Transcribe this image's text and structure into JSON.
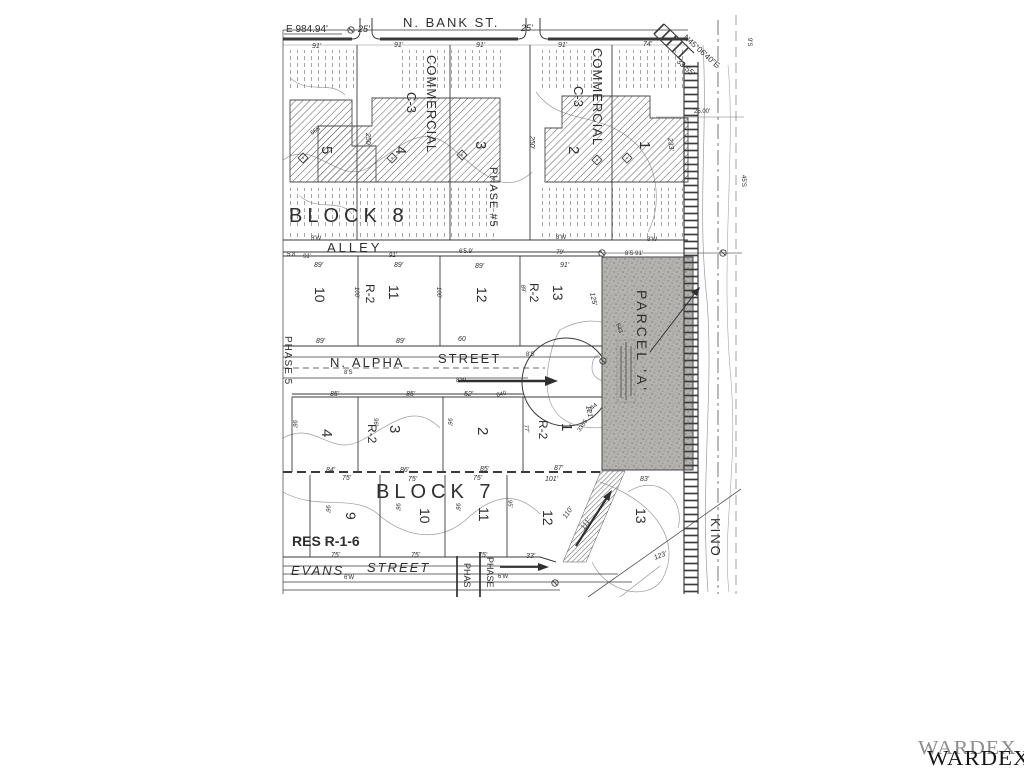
{
  "watermark": {
    "back_text": "WARDEX",
    "front_text": "WARDEX",
    "back_color": "#8d8d8d",
    "front_color": "#151515"
  },
  "map": {
    "ink": "#2f2f2f",
    "light_ink": "#7d7d7d",
    "parcel_fill": "#b4b2af",
    "labels": [
      {
        "n": "e-coordinate",
        "t": "E 984.94'",
        "x": 286,
        "y": 32,
        "s": 10
      },
      {
        "n": "dim-25-a",
        "t": "25'",
        "x": 358,
        "y": 32,
        "s": 9,
        "i": 1
      },
      {
        "n": "n-bank-st",
        "t": "N. BANK ST.",
        "x": 403,
        "y": 27,
        "s": 13,
        "ls": 2
      },
      {
        "n": "dim-25-b",
        "t": "25'",
        "x": 521,
        "y": 31,
        "s": 9,
        "i": 1
      },
      {
        "n": "bearing-ne",
        "t": "N45°06'40\"E",
        "x": 683,
        "y": 38,
        "s": 8,
        "r": 42
      },
      {
        "n": "bearing-dist",
        "t": "33.55'",
        "x": 676,
        "y": 62,
        "s": 8,
        "r": 42
      },
      {
        "n": "dim-91-a",
        "t": "91'",
        "x": 312,
        "y": 48,
        "s": 7,
        "i": 1
      },
      {
        "n": "dim-91-b",
        "t": "91'",
        "x": 394,
        "y": 47,
        "s": 7,
        "i": 1
      },
      {
        "n": "dim-91-c",
        "t": "91'",
        "x": 476,
        "y": 47,
        "s": 7,
        "i": 1
      },
      {
        "n": "dim-91-d",
        "t": "91'",
        "x": 558,
        "y": 47,
        "s": 7,
        "i": 1
      },
      {
        "n": "dim-74",
        "t": "74'",
        "x": 643,
        "y": 46,
        "s": 7,
        "i": 1
      },
      {
        "n": "commercial-a",
        "t": "COMMERCIAL",
        "x": 427,
        "y": 55,
        "s": 13,
        "r": 90,
        "ls": 1
      },
      {
        "n": "c3-a",
        "t": "C-3",
        "x": 407,
        "y": 92,
        "s": 13,
        "r": 90
      },
      {
        "n": "commercial-b",
        "t": "COMMERCIAL",
        "x": 593,
        "y": 48,
        "s": 13,
        "r": 90,
        "ls": 1
      },
      {
        "n": "c3-b",
        "t": "C-3",
        "x": 574,
        "y": 86,
        "s": 13,
        "r": 90
      },
      {
        "n": "lot8-5",
        "t": "5",
        "x": 322,
        "y": 146,
        "s": 15,
        "r": 90
      },
      {
        "n": "lot8-4",
        "t": "4",
        "x": 396,
        "y": 146,
        "s": 15,
        "r": 90
      },
      {
        "n": "lot8-3",
        "t": "3",
        "x": 476,
        "y": 141,
        "s": 15,
        "r": 90
      },
      {
        "n": "lot8-2",
        "t": "2",
        "x": 569,
        "y": 146,
        "s": 15,
        "r": 90
      },
      {
        "n": "lot8-1",
        "t": "1",
        "x": 640,
        "y": 141,
        "s": 15,
        "r": 90
      },
      {
        "n": "dim-250-a",
        "t": "250'",
        "x": 366,
        "y": 133,
        "s": 7,
        "r": 90,
        "i": 1
      },
      {
        "n": "dim-250-b",
        "t": "250'",
        "x": 530,
        "y": 136,
        "s": 7,
        "r": 90,
        "i": 1
      },
      {
        "n": "dim-233",
        "t": "233'",
        "x": 668,
        "y": 138,
        "s": 7,
        "r": 84,
        "i": 1
      },
      {
        "n": "contour-665",
        "t": "665",
        "x": 312,
        "y": 135,
        "s": 6,
        "r": -35,
        "c": "#7d7d7d"
      },
      {
        "n": "block8-title",
        "t": "BLOCK 8",
        "x": 289,
        "y": 222,
        "s": 20,
        "ls": 5
      },
      {
        "n": "phase-5-hash",
        "t": "PHASE #5",
        "x": 490,
        "y": 167,
        "s": 11,
        "r": 90,
        "ls": 1
      },
      {
        "n": "alley",
        "t": "ALLEY",
        "x": 327,
        "y": 252,
        "s": 13,
        "ls": 3
      },
      {
        "n": "dim-8w-a",
        "t": "8'W",
        "x": 311,
        "y": 240,
        "s": 6
      },
      {
        "n": "dim-8w-b",
        "t": "8'W",
        "x": 556,
        "y": 239,
        "s": 6
      },
      {
        "n": "dim-8w-c",
        "t": "8'W",
        "x": 647,
        "y": 241,
        "s": 6
      },
      {
        "n": "dim-58",
        "t": "5.8",
        "x": 287,
        "y": 256,
        "s": 6
      },
      {
        "n": "dim-91-e",
        "t": "91'",
        "x": 303,
        "y": 258,
        "s": 6,
        "i": 1
      },
      {
        "n": "dim-91-f",
        "t": "91'",
        "x": 389,
        "y": 257,
        "s": 6,
        "i": 1
      },
      {
        "n": "dim-659",
        "t": "6'5.9'",
        "x": 459,
        "y": 253,
        "s": 6
      },
      {
        "n": "dim-79",
        "t": "79'",
        "x": 556,
        "y": 254,
        "s": 6,
        "i": 1
      },
      {
        "n": "dim-8s91",
        "t": "8'S 91'",
        "x": 625,
        "y": 255,
        "s": 6
      },
      {
        "n": "dim-89-a",
        "t": "89'",
        "x": 314,
        "y": 267,
        "s": 7,
        "i": 1
      },
      {
        "n": "dim-89-b",
        "t": "89'",
        "x": 394,
        "y": 267,
        "s": 7,
        "i": 1
      },
      {
        "n": "dim-89-c",
        "t": "89'",
        "x": 475,
        "y": 268,
        "s": 7,
        "i": 1
      },
      {
        "n": "dim-91-g",
        "t": "91'",
        "x": 560,
        "y": 267,
        "s": 7,
        "i": 1
      },
      {
        "n": "lot-10",
        "t": "10",
        "x": 315,
        "y": 287,
        "s": 14,
        "r": 90
      },
      {
        "n": "lot-11",
        "t": "11",
        "x": 389,
        "y": 285,
        "s": 14,
        "r": 90
      },
      {
        "n": "r2-a",
        "t": "R-2",
        "x": 366,
        "y": 284,
        "s": 12,
        "r": 90
      },
      {
        "n": "lot-12",
        "t": "12",
        "x": 477,
        "y": 287,
        "s": 14,
        "r": 90
      },
      {
        "n": "lot-13",
        "t": "13",
        "x": 553,
        "y": 285,
        "s": 14,
        "r": 90
      },
      {
        "n": "r2-b",
        "t": "R-2",
        "x": 530,
        "y": 283,
        "s": 12,
        "r": 90
      },
      {
        "n": "dim-100-a",
        "t": "100'",
        "x": 355,
        "y": 287,
        "s": 6,
        "r": 90,
        "i": 1
      },
      {
        "n": "dim-100-b",
        "t": "100'",
        "x": 437,
        "y": 287,
        "s": 6,
        "r": 90,
        "i": 1
      },
      {
        "n": "dim-89-d",
        "t": "89'",
        "x": 521,
        "y": 285,
        "s": 6,
        "r": 80,
        "i": 1
      },
      {
        "n": "dim-125",
        "t": "125'",
        "x": 590,
        "y": 293,
        "s": 7,
        "r": 78,
        "i": 1
      },
      {
        "n": "phase-5-left",
        "t": "PHASE 5",
        "x": 285,
        "y": 336,
        "s": 10,
        "r": 90,
        "ls": 1
      },
      {
        "n": "dim-89-e",
        "t": "89'",
        "x": 316,
        "y": 343,
        "s": 7,
        "i": 1
      },
      {
        "n": "dim-89-f",
        "t": "89'",
        "x": 396,
        "y": 343,
        "s": 7,
        "i": 1
      },
      {
        "n": "n-alpha",
        "t": "N. ALPHA",
        "x": 330,
        "y": 367,
        "s": 13,
        "ls": 2
      },
      {
        "n": "n-alpha-street",
        "t": "STREET",
        "x": 438,
        "y": 363,
        "s": 13,
        "ls": 2
      },
      {
        "n": "dim-8s-a",
        "t": "8'S",
        "x": 344,
        "y": 374,
        "s": 6
      },
      {
        "n": "dim-8w-d",
        "t": "8'W",
        "x": 456,
        "y": 382,
        "s": 6
      },
      {
        "n": "dim-8s-b",
        "t": "8'S",
        "x": 526,
        "y": 356,
        "s": 6
      },
      {
        "n": "dim-60",
        "t": "60",
        "x": 458,
        "y": 341,
        "s": 7,
        "i": 1
      },
      {
        "n": "dim-85-a",
        "t": "85'",
        "x": 330,
        "y": 396,
        "s": 7,
        "i": 1
      },
      {
        "n": "dim-85-b",
        "t": "85'",
        "x": 406,
        "y": 396,
        "s": 7,
        "i": 1
      },
      {
        "n": "dim-52",
        "t": "52'",
        "x": 464,
        "y": 396,
        "s": 7,
        "i": 1
      },
      {
        "n": "lot7-4",
        "t": "4",
        "x": 322,
        "y": 429,
        "s": 15,
        "r": 90
      },
      {
        "n": "lot7-3",
        "t": "3",
        "x": 390,
        "y": 425,
        "s": 15,
        "r": 90
      },
      {
        "n": "r2-c",
        "t": "R-2",
        "x": 368,
        "y": 424,
        "s": 12,
        "r": 90
      },
      {
        "n": "lot7-2",
        "t": "2",
        "x": 478,
        "y": 427,
        "s": 15,
        "r": 90
      },
      {
        "n": "lot7-1",
        "t": "1",
        "x": 562,
        "y": 423,
        "s": 15,
        "r": 90
      },
      {
        "n": "r2-d",
        "t": "R-2",
        "x": 539,
        "y": 420,
        "s": 12,
        "r": 90
      },
      {
        "n": "dim-96-a",
        "t": "96'",
        "x": 293,
        "y": 420,
        "s": 6,
        "r": 90,
        "i": 1
      },
      {
        "n": "dim-96-b",
        "t": "96'",
        "x": 374,
        "y": 418,
        "s": 6,
        "r": 90,
        "i": 1
      },
      {
        "n": "dim-96-c",
        "t": "96'",
        "x": 448,
        "y": 418,
        "s": 6,
        "r": 90,
        "i": 1
      },
      {
        "n": "dim-77",
        "t": "77'",
        "x": 524,
        "y": 425,
        "s": 6,
        "r": 80,
        "i": 1
      },
      {
        "n": "dim-121",
        "t": "121'",
        "x": 586,
        "y": 406,
        "s": 7,
        "r": 78,
        "i": 1
      },
      {
        "n": "contour-3355",
        "t": "3355",
        "x": 580,
        "y": 432,
        "s": 6,
        "r": -55,
        "c": "#7d7d7d"
      },
      {
        "n": "dim-84",
        "t": "84'",
        "x": 326,
        "y": 472,
        "s": 7,
        "i": 1
      },
      {
        "n": "dim-86",
        "t": "86'",
        "x": 400,
        "y": 472,
        "s": 7,
        "i": 1
      },
      {
        "n": "dim-85-c",
        "t": "85'",
        "x": 480,
        "y": 471,
        "s": 7,
        "i": 1
      },
      {
        "n": "dim-87",
        "t": "87'",
        "x": 554,
        "y": 470,
        "s": 7,
        "i": 1
      },
      {
        "n": "dim-101",
        "t": "101'",
        "x": 545,
        "y": 481,
        "s": 7,
        "i": 1
      },
      {
        "n": "dim-83",
        "t": "83'",
        "x": 640,
        "y": 481,
        "s": 7,
        "i": 1
      },
      {
        "n": "dim-75-a",
        "t": "75'",
        "x": 342,
        "y": 480,
        "s": 7,
        "i": 1
      },
      {
        "n": "dim-75-b",
        "t": "75'",
        "x": 408,
        "y": 481,
        "s": 7,
        "i": 1
      },
      {
        "n": "dim-75-c",
        "t": "75'",
        "x": 473,
        "y": 480,
        "s": 7,
        "i": 1
      },
      {
        "n": "block7-title",
        "t": "BLOCK 7",
        "x": 376,
        "y": 498,
        "s": 20,
        "ls": 5
      },
      {
        "n": "lot7-9",
        "t": "9",
        "x": 346,
        "y": 512,
        "s": 14,
        "r": 90
      },
      {
        "n": "lot7-10",
        "t": "10",
        "x": 420,
        "y": 508,
        "s": 14,
        "r": 90
      },
      {
        "n": "lot7-11",
        "t": "11",
        "x": 479,
        "y": 507,
        "s": 14,
        "r": 90
      },
      {
        "n": "lot7-12",
        "t": "12",
        "x": 543,
        "y": 510,
        "s": 14,
        "r": 90
      },
      {
        "n": "lot7-13",
        "t": "13",
        "x": 636,
        "y": 508,
        "s": 14,
        "r": 90
      },
      {
        "n": "dim-96-d",
        "t": "96'",
        "x": 326,
        "y": 505,
        "s": 6,
        "r": 90,
        "i": 1
      },
      {
        "n": "dim-96-e",
        "t": "96'",
        "x": 396,
        "y": 503,
        "s": 6,
        "r": 90,
        "i": 1
      },
      {
        "n": "dim-96-f",
        "t": "96'",
        "x": 456,
        "y": 503,
        "s": 6,
        "r": 90,
        "i": 1
      },
      {
        "n": "dim-95",
        "t": "95'",
        "x": 508,
        "y": 500,
        "s": 6,
        "r": 84,
        "i": 1
      },
      {
        "n": "res-r-1-6",
        "t": "RES R-1-6",
        "x": 292,
        "y": 546,
        "s": 14,
        "b": 1
      },
      {
        "n": "dim-75-d",
        "t": "75'",
        "x": 331,
        "y": 557,
        "s": 7,
        "i": 1
      },
      {
        "n": "dim-75-e",
        "t": "75'",
        "x": 411,
        "y": 557,
        "s": 7,
        "i": 1
      },
      {
        "n": "dim-75-f",
        "t": "75'",
        "x": 478,
        "y": 557,
        "s": 7,
        "i": 1
      },
      {
        "n": "dim-33",
        "t": "33'",
        "x": 526,
        "y": 558,
        "s": 7,
        "i": 1
      },
      {
        "n": "evans",
        "t": "EVANS",
        "x": 291,
        "y": 575,
        "s": 13,
        "i": 1,
        "ls": 2
      },
      {
        "n": "evans-street",
        "t": "STREET",
        "x": 367,
        "y": 572,
        "s": 13,
        "i": 1,
        "ls": 2
      },
      {
        "n": "phase-evans-a",
        "t": "PHAS",
        "x": 464,
        "y": 563,
        "s": 9,
        "r": 90
      },
      {
        "n": "phase-evans-b",
        "t": "PHASE",
        "x": 487,
        "y": 557,
        "s": 9,
        "r": 90
      },
      {
        "n": "dim-6w-a",
        "t": "6'W",
        "x": 344,
        "y": 579,
        "s": 6
      },
      {
        "n": "dim-6w-b",
        "t": "6'W",
        "x": 498,
        "y": 578,
        "s": 6
      },
      {
        "n": "dim-110",
        "t": "110'",
        "x": 566,
        "y": 519,
        "s": 7,
        "r": -55,
        "i": 1
      },
      {
        "n": "dim-111",
        "t": "111'",
        "x": 584,
        "y": 530,
        "s": 7,
        "r": -55,
        "i": 1
      },
      {
        "n": "dim-123",
        "t": "123'",
        "x": 655,
        "y": 560,
        "s": 7,
        "r": -22,
        "i": 1
      },
      {
        "n": "parcel-a",
        "t": "PARCEL 'A'",
        "x": 637,
        "y": 290,
        "s": 14,
        "r": 90,
        "ls": 3,
        "c": "#4d4b49"
      },
      {
        "n": "kino",
        "t": "KINO",
        "x": 711,
        "y": 518,
        "s": 13,
        "r": 90,
        "ls": 2,
        "c": "#5a5a5a"
      },
      {
        "n": "dim-2500",
        "t": "25.00'",
        "x": 694,
        "y": 113,
        "s": 6,
        "c": "#6a6a6a"
      },
      {
        "n": "dim-9s",
        "t": "9'S",
        "x": 748,
        "y": 38,
        "s": 6,
        "r": 90,
        "c": "#7d7d7d"
      },
      {
        "n": "dim-45s",
        "t": "45'S",
        "x": 742,
        "y": 175,
        "s": 6,
        "r": 90,
        "c": "#7d7d7d"
      },
      {
        "n": "contour-643",
        "t": "643",
        "x": 616,
        "y": 324,
        "s": 6,
        "r": 70,
        "c": "#7d7d7d"
      },
      {
        "n": "contour-644",
        "t": "644",
        "x": 590,
        "y": 412,
        "s": 6,
        "r": -40,
        "c": "#7d7d7d"
      },
      {
        "n": "contour-640",
        "t": "640",
        "x": 497,
        "y": 397,
        "s": 6,
        "r": -15,
        "c": "#7d7d7d"
      }
    ]
  }
}
